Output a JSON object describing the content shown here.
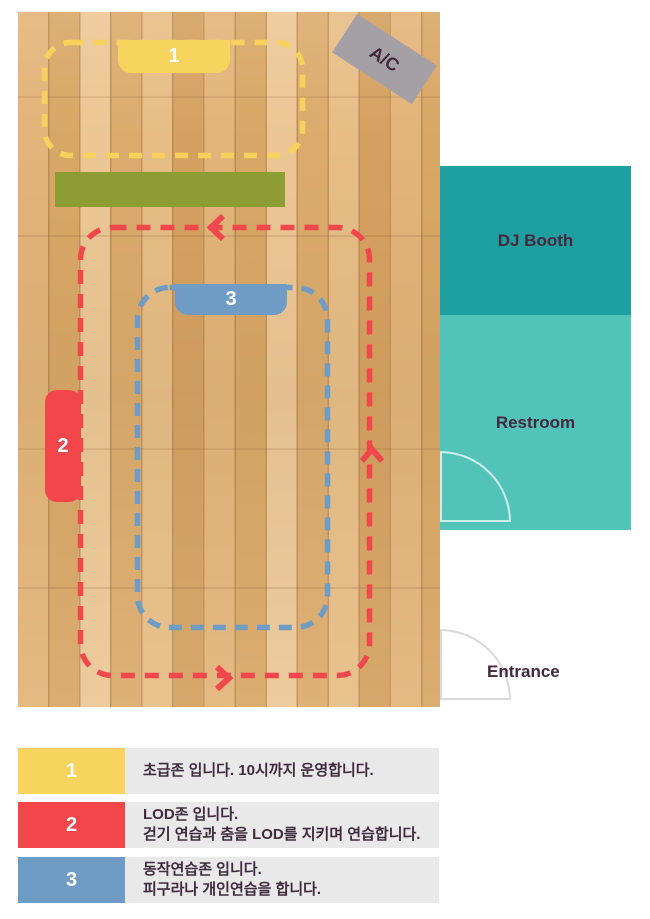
{
  "floor": {
    "ac_label": "A/C"
  },
  "zones": {
    "zone1": {
      "number": "1",
      "color": "#f6d45e",
      "outline": "#f8d15c"
    },
    "zone2": {
      "number": "2",
      "color": "#f2464b",
      "outline": "#f0474c"
    },
    "zone3": {
      "number": "3",
      "color": "#6f9cc5",
      "outline": "#6f9cc5"
    }
  },
  "rooms": {
    "dj_booth": {
      "label": "DJ Booth",
      "color": "#1fa0a0"
    },
    "restroom": {
      "label": "Restroom",
      "color": "#52c3b9"
    },
    "entrance": {
      "label": "Entrance"
    }
  },
  "legend": {
    "items": [
      {
        "number": "1",
        "color": "#f6d45e",
        "line1": "초급존 입니다. 10시까지 운영합니다."
      },
      {
        "number": "2",
        "color": "#f2464b",
        "line1": "LOD존 입니다.",
        "line2": "걷기 연습과 춤을 LOD를 지키며 연습합니다."
      },
      {
        "number": "3",
        "color": "#6f9cc5",
        "line1": "동작연습존 입니다.",
        "line2": "피구라나 개인연습을 합니다."
      }
    ]
  },
  "palette": {
    "green_bar": "#8d9c33",
    "ac_sign": "#a5a0a5",
    "legend_bg": "#e9e9e9",
    "text_dark": "#44283e",
    "wood_base": "#dfb078"
  }
}
